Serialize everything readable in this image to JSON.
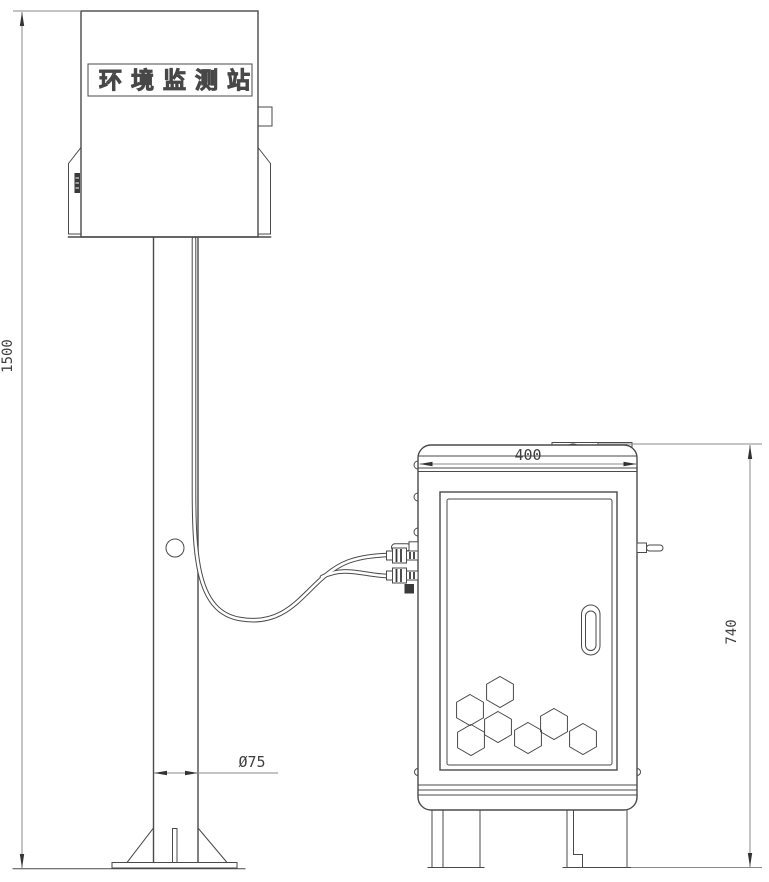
{
  "head_unit": {
    "name_plate_label": "环境监测站"
  },
  "dimensions": {
    "overall_height": {
      "label": "1500"
    },
    "pole_diameter": {
      "label": "Ø75"
    },
    "cabinet_width": {
      "label": "400"
    },
    "cabinet_height": {
      "label": "740"
    }
  },
  "cabinet": {
    "hexagon_radius": 15.5,
    "hexagon_centers": [
      [
        500,
        692
      ],
      [
        470,
        710
      ],
      [
        498,
        727
      ],
      [
        471,
        740
      ],
      [
        528,
        738
      ],
      [
        554,
        724
      ],
      [
        583,
        739
      ]
    ]
  },
  "colors": {
    "line": "#4a4a4a",
    "dim": "#8a8a8a",
    "fill": "#ffffff",
    "dark_fill": "#3a3a3a",
    "background": "#ffffff"
  }
}
